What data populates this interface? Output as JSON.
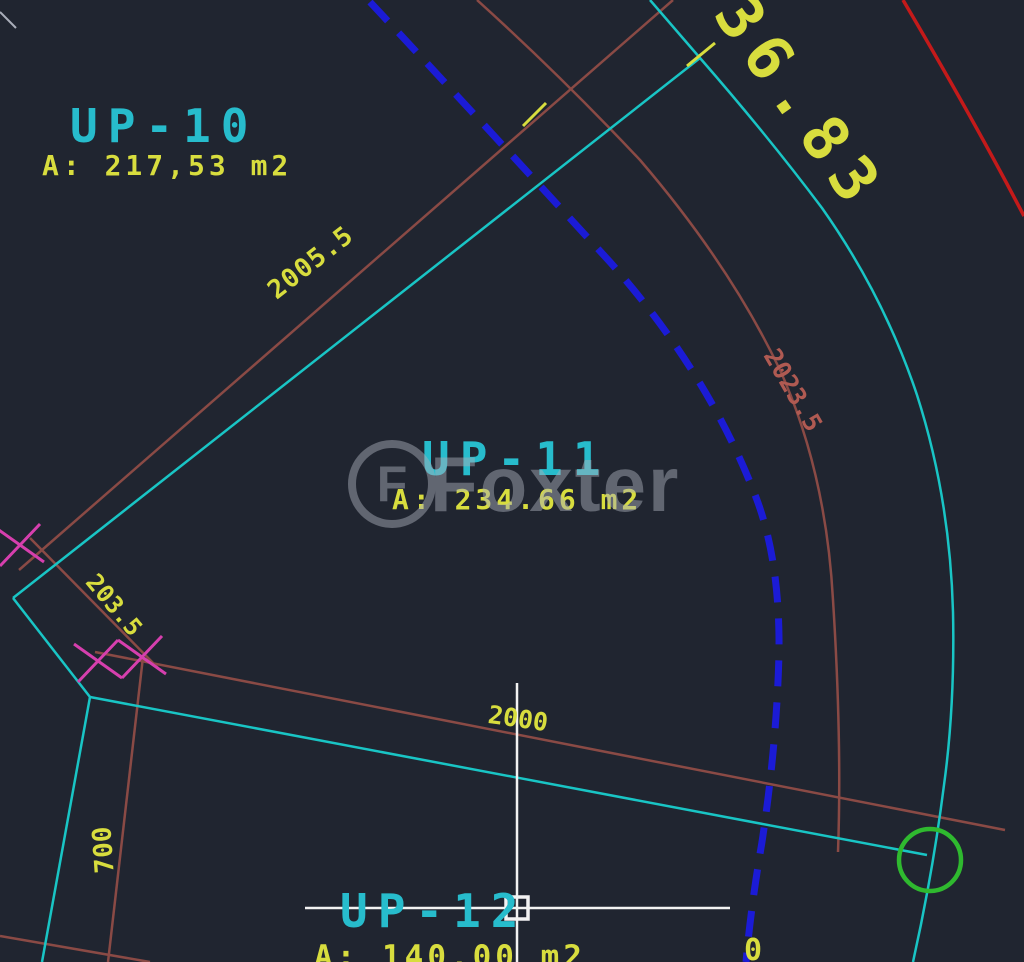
{
  "canvas": {
    "width": 1024,
    "height": 962
  },
  "palette": {
    "bg": "#202530",
    "cyan": "#19c5c5",
    "cyanText": "#27bccc",
    "yellow": "#d8dd3e",
    "brown": "#8a4a45",
    "brownText": "#b05a52",
    "red": "#c41a1a",
    "blue": "#1b1bd6",
    "magenta": "#d63fae",
    "green": "#2fb92f",
    "white": "#f2f2f2",
    "watermark": "#a9aeb9"
  },
  "watermark": {
    "brand": "Foxter",
    "logo_letter": "F"
  },
  "lots": {
    "up10": {
      "name": "UP-10",
      "area": "A: 217,53 m2"
    },
    "up11": {
      "name": "UP-11",
      "area": "A: 234.66 m2"
    },
    "up12": {
      "name": "UP-12",
      "area": "A: 140,00 m2"
    }
  },
  "dims": {
    "d36_83": "36.83",
    "d2005_5": "2005.5",
    "d203_5": "203.5",
    "d2023_5": "2023.5",
    "d2000": "2000",
    "d700": "700",
    "partial_glyph": "0"
  }
}
